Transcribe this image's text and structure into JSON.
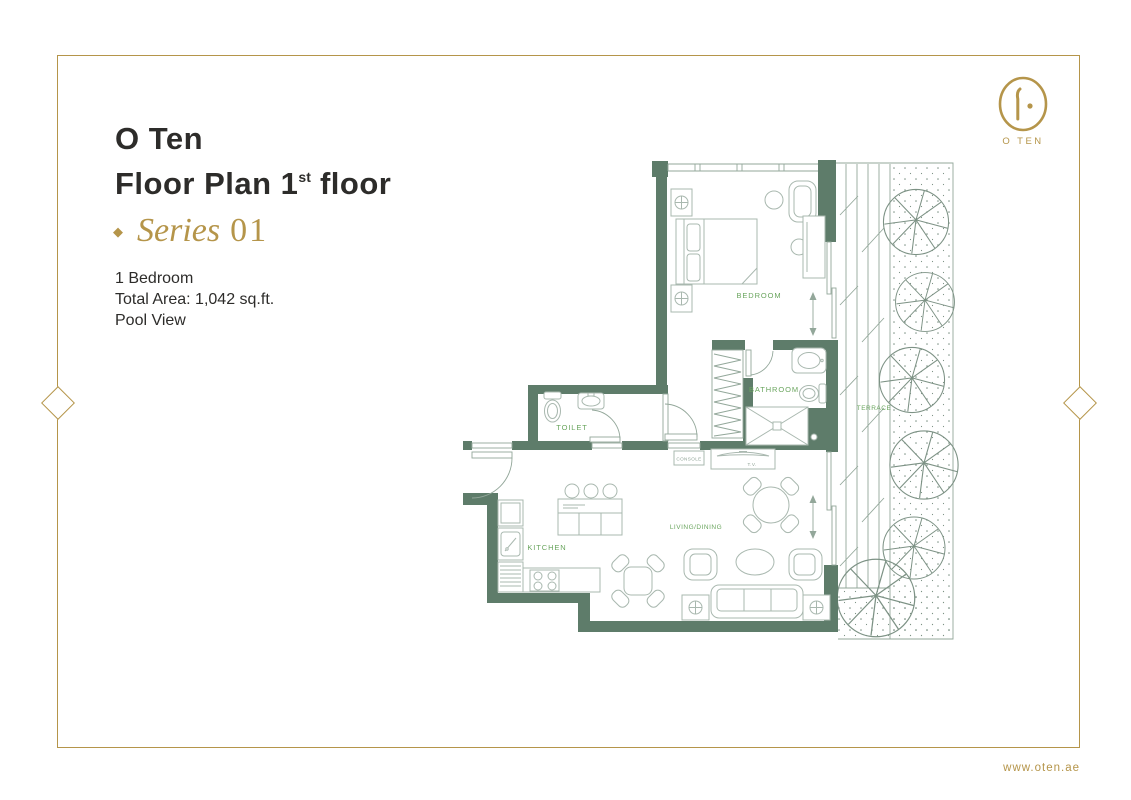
{
  "header": {
    "title_line1": "O Ten",
    "title_line2_prefix": "Floor Plan 1",
    "title_line2_sup": "st",
    "title_line2_suffix": " floor",
    "series_bullet": "◆",
    "series_label": "Series",
    "series_number": "01"
  },
  "details": {
    "line1": "1 Bedroom",
    "line2": "Total Area: 1,042  sq.ft.",
    "line3": "Pool View"
  },
  "logo": {
    "text": "O TEN"
  },
  "footer": {
    "website": "www.oten.ae"
  },
  "floor_plan": {
    "rooms": [
      {
        "id": "bedroom",
        "label": "BEDROOM"
      },
      {
        "id": "bathroom",
        "label": "BATHROOM"
      },
      {
        "id": "toilet",
        "label": "TOILET"
      },
      {
        "id": "kitchen",
        "label": "KITCHEN"
      },
      {
        "id": "living_dining",
        "label": "LIVING/DINING"
      },
      {
        "id": "terrace",
        "label": "TERRACE"
      }
    ],
    "furniture_labels": {
      "console": "CONSOLE",
      "tv": "T.V."
    }
  },
  "colors": {
    "gold": "#b5954a",
    "wall_green": "#5e7c6a",
    "label_green": "#6aa55e",
    "line_gray": "#a9b8af",
    "text_dark": "#2d2c2a"
  }
}
